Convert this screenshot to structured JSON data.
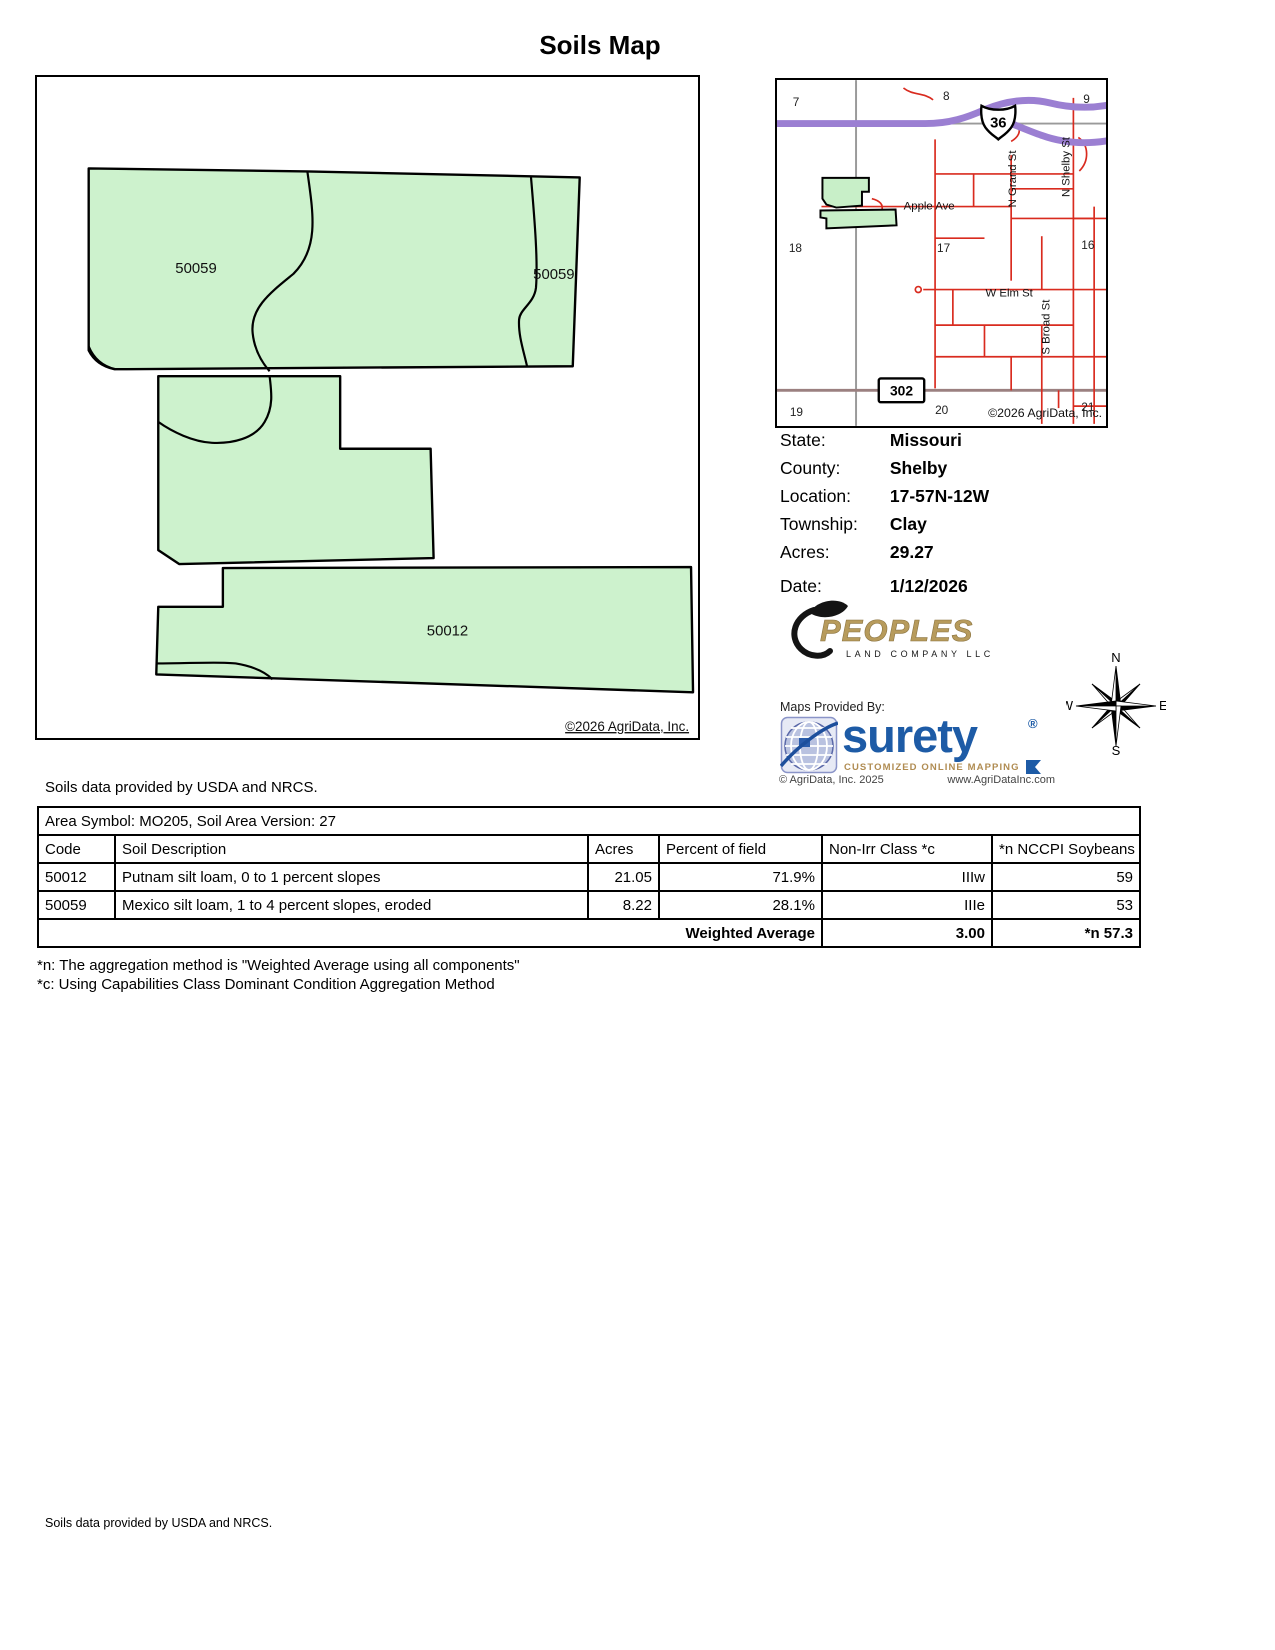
{
  "title": "Soils Map",
  "map": {
    "labels": [
      "50059",
      "50059",
      "50012"
    ],
    "copyright": "©2026 AgriData, Inc.",
    "parcel_fill": "#cdf2cd"
  },
  "locator": {
    "sections": [
      "7",
      "8",
      "9",
      "18",
      "17",
      "16",
      "19",
      "20",
      "21"
    ],
    "streets": {
      "apple": "Apple Ave",
      "elm": "W Elm St",
      "grand": "N Grand St",
      "shelby": "N Shelby St",
      "broad": "S Broad St"
    },
    "badges": {
      "us36": "36",
      "route302": "302"
    },
    "copyright": "©2026 AgriData, Inc.",
    "highway_color": "#9b7fd2",
    "street_color": "#d92b1f"
  },
  "info": {
    "rows": [
      {
        "label": "State:",
        "value": "Missouri"
      },
      {
        "label": "County:",
        "value": "Shelby"
      },
      {
        "label": "Location:",
        "value": "17-57N-12W"
      },
      {
        "label": "Township:",
        "value": "Clay"
      },
      {
        "label": "Acres:",
        "value": "29.27"
      },
      {
        "label": "Date:",
        "value": "1/12/2026"
      }
    ]
  },
  "branding": {
    "peoples_name": "PEOPLES",
    "peoples_sub": "LAND COMPANY LLC",
    "peoples_gold": "#b79b5c",
    "provided_by": "Maps Provided By:",
    "surety_word": "surety",
    "surety_reg": "®",
    "surety_tagline": "CUSTOMIZED ONLINE MAPPING",
    "surety_blue": "#1d5ba6",
    "copyright": "© AgriData, Inc. 2025",
    "website": "www.AgriDataInc.com"
  },
  "compass": {
    "n": "N",
    "e": "E",
    "s": "S",
    "w": "W"
  },
  "notes": {
    "soils_top": "Soils data provided by USDA and NRCS.",
    "soils_bottom": "Soils data provided by USDA and NRCS."
  },
  "table": {
    "area_header": "Area Symbol: MO205, Soil Area Version: 27",
    "columns": [
      "Code",
      "Soil Description",
      "Acres",
      "Percent of field",
      "Non-Irr Class *c",
      "*n NCCPI Soybeans"
    ],
    "rows": [
      {
        "code": "50012",
        "description": "Putnam silt loam, 0 to 1 percent slopes",
        "acres": "21.05",
        "percent": "71.9%",
        "nonirr": "IIIw",
        "nccpi": "59"
      },
      {
        "code": "50059",
        "description": "Mexico silt loam, 1 to 4 percent slopes, eroded",
        "acres": "8.22",
        "percent": "28.1%",
        "nonirr": "IIIe",
        "nccpi": "53"
      }
    ],
    "weighted": {
      "label": "Weighted Average",
      "nonirr": "3.00",
      "nccpi": "*n 57.3"
    }
  },
  "footnotes": [
    "*n: The aggregation method is \"Weighted Average using all components\"",
    "*c: Using Capabilities Class Dominant Condition Aggregation Method"
  ]
}
